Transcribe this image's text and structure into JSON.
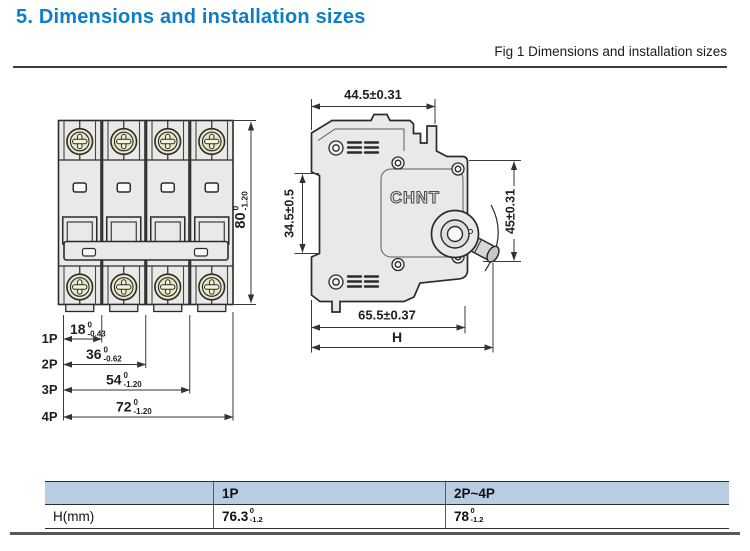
{
  "page": {
    "title": "5. Dimensions and installation sizes",
    "figure_caption": "Fig 1 Dimensions and installation sizes"
  },
  "front_view": {
    "height_dim": {
      "value": "80",
      "tol_top": "0",
      "tol_bottom": "-1.20"
    },
    "pole_dims": [
      {
        "label": "1P",
        "value": "18",
        "tol_top": "0",
        "tol_bottom": "-0.43"
      },
      {
        "label": "2P",
        "value": "36",
        "tol_top": "0",
        "tol_bottom": "-0.62"
      },
      {
        "label": "3P",
        "value": "54",
        "tol_top": "0",
        "tol_bottom": "-1.20"
      },
      {
        "label": "4P",
        "value": "72",
        "tol_top": "0",
        "tol_bottom": "-1.20"
      }
    ]
  },
  "side_view": {
    "brand": "CHNT",
    "top_width_dim": "44.5±0.31",
    "left_height_dim": "34.5±0.5",
    "right_height_dim": "45±0.31",
    "bottom_width_dim": "65.5±0.37",
    "overall_width_label": "H"
  },
  "table": {
    "headers": [
      "",
      "1P",
      "2P~4P"
    ],
    "row_label": "H(mm)",
    "col1": {
      "value": "76.3",
      "tol_top": "0",
      "tol_bottom": "-1.2"
    },
    "col2": {
      "value": "78",
      "tol_top": "0",
      "tol_bottom": "-1.2"
    }
  },
  "colors": {
    "accent": "#0d7ec6",
    "table_header_bg": "#b9cde2",
    "body_fill": "#e9eae7",
    "screw_fill": "#e9e6c6",
    "line": "#2b2b2b"
  }
}
